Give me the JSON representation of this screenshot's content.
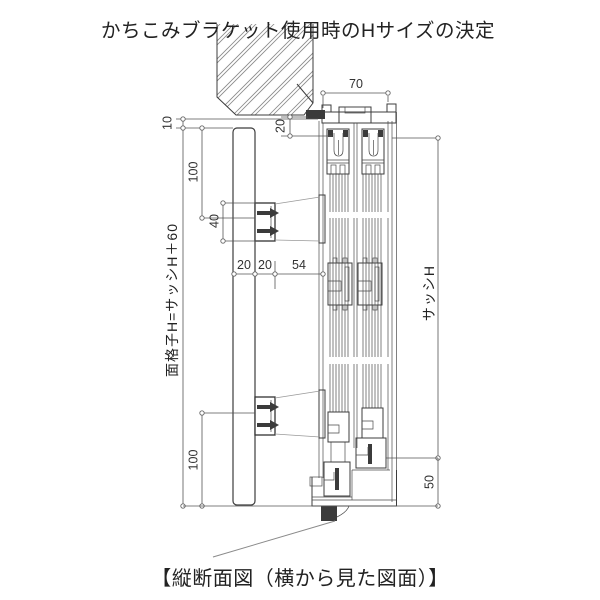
{
  "title": "かちこみブラケット使用時のHサイズの決定",
  "caption": "【縦断面図（横から見た図面）】",
  "drawing": {
    "dimensions": {
      "frame_depth": "70",
      "head_overlap": "20",
      "grille_top_offset": "10",
      "grille_top_to_bracket": "100",
      "bracket_height": "40",
      "grille_depth": "20",
      "bracket_depth": "20",
      "bracket_to_frame": "54",
      "bracket_to_grille_bottom": "100",
      "sill_below_sash": "50",
      "sash_height": "サッシH",
      "grille_height": "面格子H=サッシH＋60"
    },
    "colors": {
      "line": "#3c3c3c",
      "dimension": "#555555",
      "hatch": "#8a8a8a",
      "background": "#ffffff"
    }
  }
}
